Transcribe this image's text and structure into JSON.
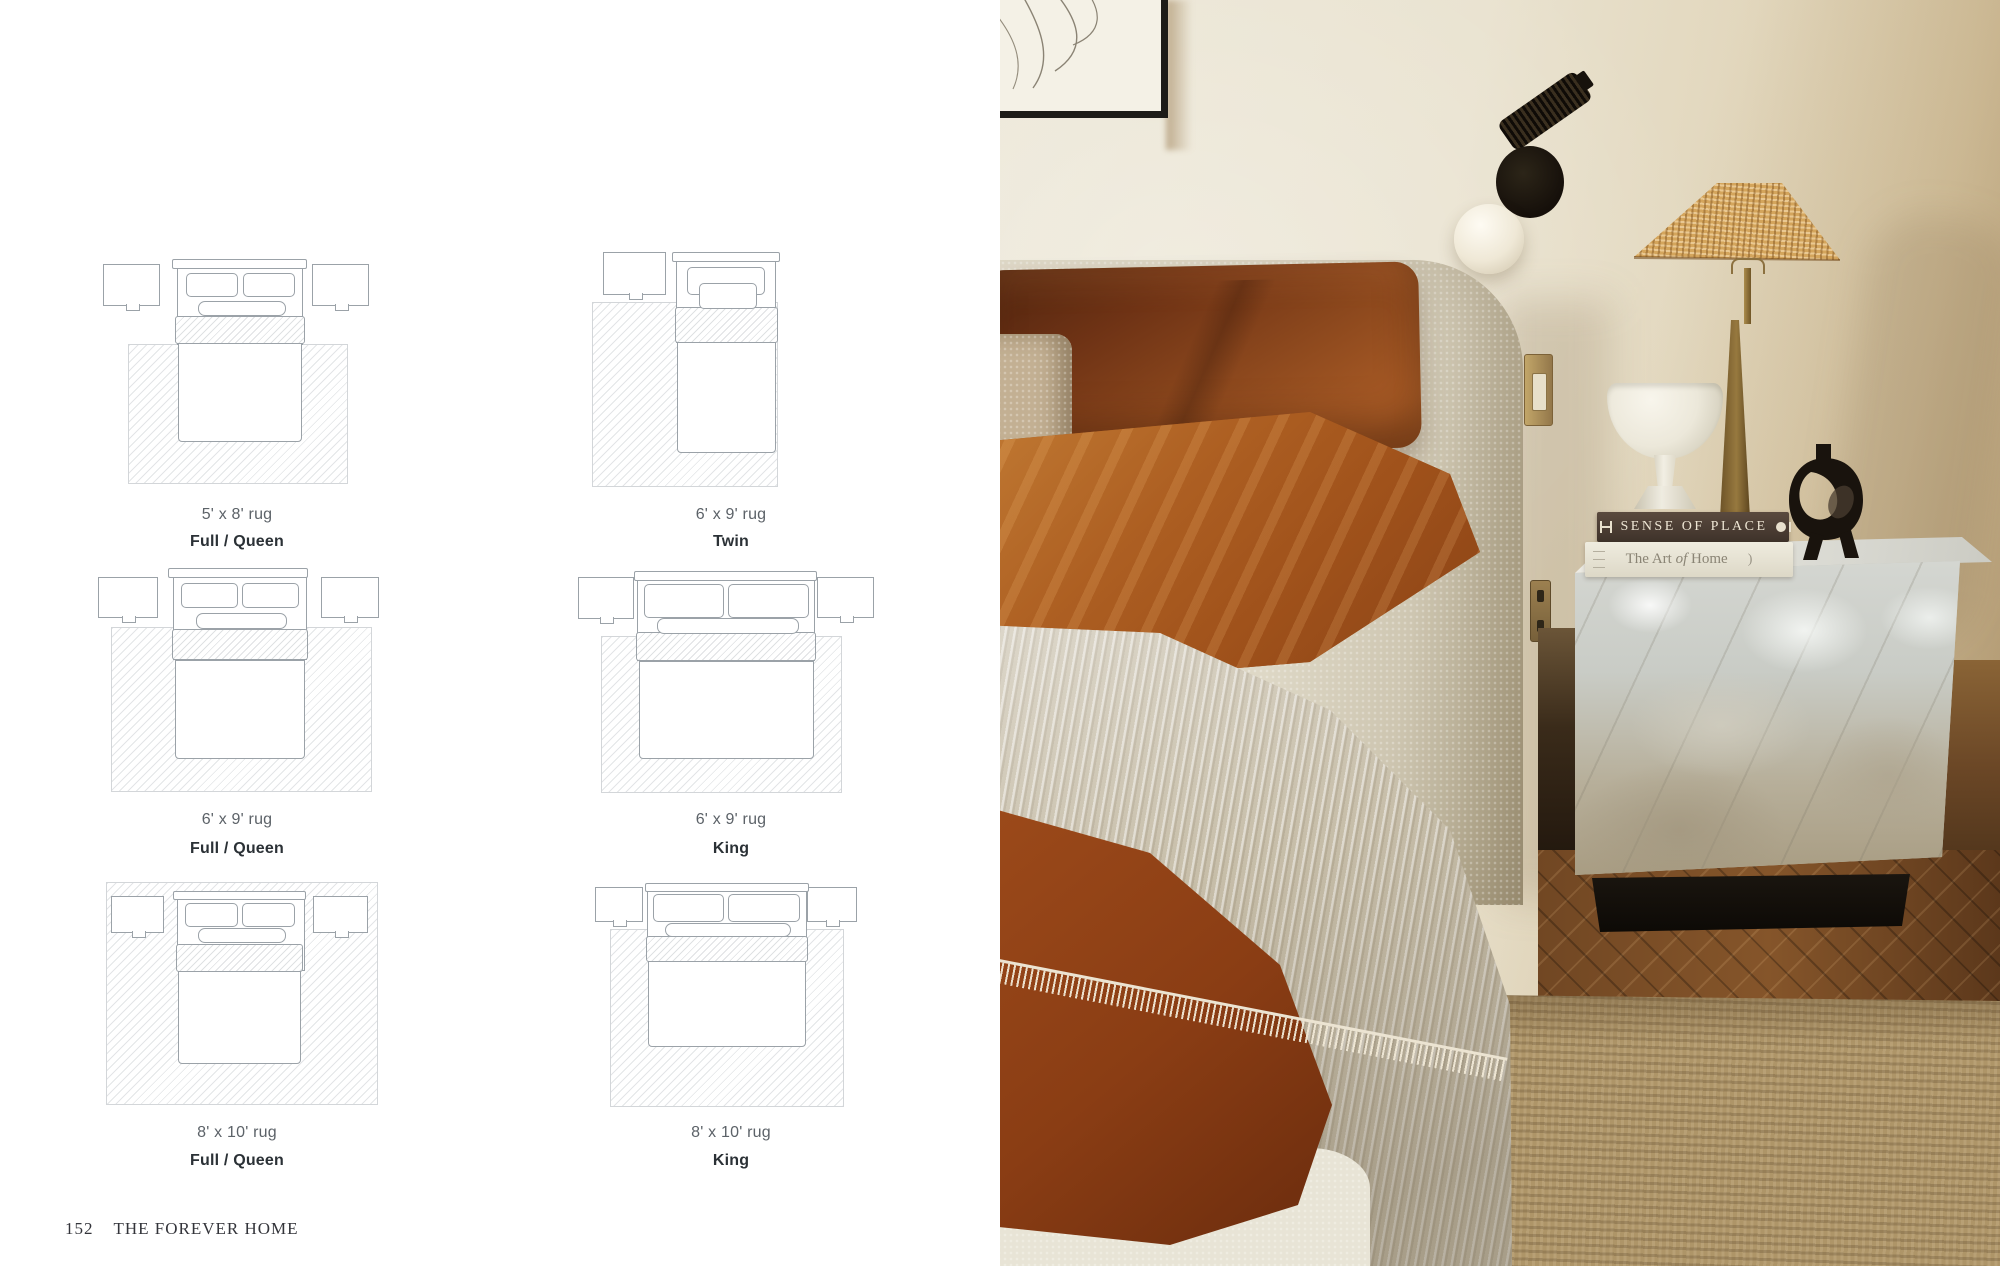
{
  "book": {
    "footer": {
      "page_number": "152",
      "title": "THE FOREVER HOME"
    },
    "diagrams": [
      {
        "size_label": "5' x 8' rug",
        "type_label": "Full / Queen",
        "bed": "full-queen",
        "nightstands": 2
      },
      {
        "size_label": "6' x 9' rug",
        "type_label": "Twin",
        "bed": "twin",
        "nightstands": 1
      },
      {
        "size_label": "6' x 9' rug",
        "type_label": "Full / Queen",
        "bed": "full-queen",
        "nightstands": 2
      },
      {
        "size_label": "6' x 9' rug",
        "type_label": "King",
        "bed": "king",
        "nightstands": 2
      },
      {
        "size_label": "8' x 10' rug",
        "type_label": "Full / Queen",
        "bed": "full-queen",
        "nightstands": 2
      },
      {
        "size_label": "8' x 10' rug",
        "type_label": "King",
        "bed": "king",
        "nightstands": 2
      }
    ],
    "photo": {
      "books": {
        "top_spine": "SENSE OF PLACE",
        "bottom_spine_pre": "The Art",
        "bottom_spine_mid": "of",
        "bottom_spine_post": "Home",
        "bottom_spine_mark": ")"
      },
      "objects": [
        "framed-line-art",
        "black-wall-sconce",
        "white-globe-bulb",
        "rattan-table-lamp",
        "brass-lamp-stem",
        "marble-pedestal-bowl",
        "black-abstract-sculpture",
        "marble-cube-side-table",
        "black-plinth-base",
        "boucle-headboard",
        "rust-linen-pillow",
        "rust-linen-sheet",
        "greige-gauze-blanket",
        "rust-duvet",
        "boucle-bed-base",
        "jute-rug",
        "herringbone-wood-floor",
        "brass-light-switch",
        "brass-outlet"
      ],
      "palette": {
        "wall": "#e9e3d3",
        "rust": "#a0521c",
        "rust_dark": "#6f3315",
        "boucle": "#ddd7c7",
        "blanket": "#c7bea9",
        "marble": "#c9ccc5",
        "rattan": "#d4a55c",
        "jute": "#ae9568",
        "wood": "#6f4521",
        "plinth": "#14110d",
        "diagram_line": "#9ba2a8",
        "label_text": "#2b3136"
      }
    }
  }
}
